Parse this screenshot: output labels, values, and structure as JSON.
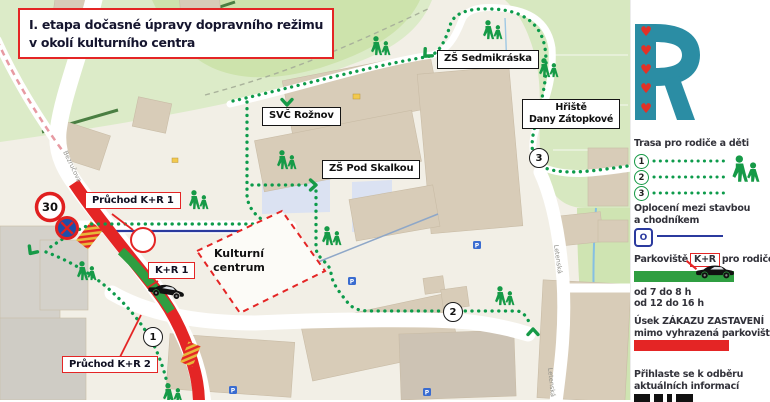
{
  "title": {
    "line1": "I. etapa dočasné úpravy dopravního režimu",
    "line2": "v okolí kulturního centra"
  },
  "map": {
    "places": {
      "svc": "SVČ Rožnov",
      "sedmikraska": "ZŠ Sedmikráska",
      "pod_skalkou": "ZŠ Pod Skalkou",
      "hriste_l1": "Hřiště",
      "hriste_l2": "Dany Zátopkové",
      "kulturni_l1": "Kulturní",
      "kulturni_l2": "centrum"
    },
    "callouts": {
      "pruchod1": "Průchod K+R 1",
      "kr1": "K+R 1",
      "pruchod2": "Průchod K+R 2"
    },
    "signs": {
      "speed_limit": "30"
    },
    "markers": {
      "m1": "1",
      "m2": "2",
      "m3": "3"
    },
    "streets": {
      "bezrucova": "Bezručova",
      "letenska": "Letenská"
    },
    "parking_letter": "P",
    "icons": {
      "heart_glyph": "♥",
      "people": "parent-child-walking-icon",
      "car": "car-side-icon",
      "no_stopping": "no-stopping-sign-icon",
      "chevron": "route-direction-chevron-icon"
    }
  },
  "legend": {
    "logo_letter": "R",
    "route_title": "Trasa pro rodiče a děti",
    "route_numbers": [
      "1",
      "2",
      "3"
    ],
    "fence_l1": "Oplocení mezi stavbou",
    "fence_l2": "a chodníkem",
    "fence_symbol": "O",
    "parking_prefix": "Parkoviště",
    "parking_badge": "K+R",
    "parking_suffix": "pro rodiče",
    "time1": "od 7 do 8 h",
    "time2": "od 12 do 16 h",
    "ban_l1": "Úsek ZÁKAZU ZASTAVENÍ",
    "ban_l2": "mimo vyhrazená parkoviště",
    "subscribe_l1": "Přihlaste se k odběru",
    "subscribe_l2": "aktuálních informací"
  },
  "colors": {
    "accent_red": "#e42525",
    "route_green": "#0d9b4b",
    "strip_green": "#2f9e41",
    "brand_teal": "#2b8da4",
    "fence_blue": "#2b3a9e",
    "heart_red": "#e23127"
  }
}
